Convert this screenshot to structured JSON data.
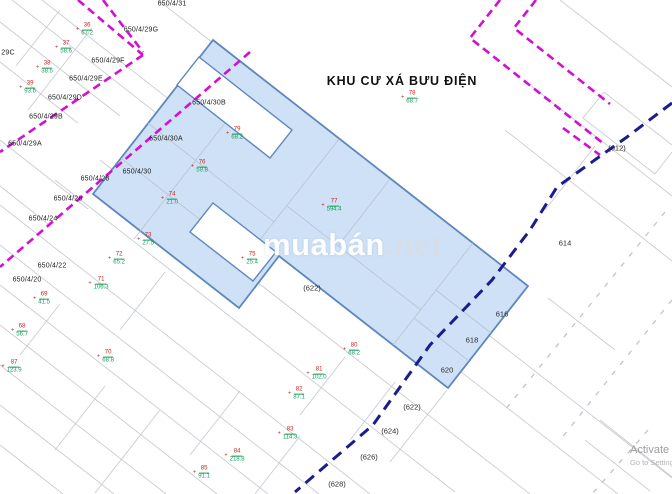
{
  "title": "KHU CƯ XÁ BƯU ĐIỆN",
  "watermark": {
    "brand": "muabán",
    "tld": ".net"
  },
  "activation": {
    "line1": "Activate Windows",
    "line2": "Go to Settings to activate Windows."
  },
  "streets": [
    {
      "label": "650/4/31"
    },
    {
      "label": "650/4/29G"
    },
    {
      "label": "650/4/29F"
    },
    {
      "label": "650/4/29E"
    },
    {
      "label": "650/4/29D"
    },
    {
      "label": "650/4/29B"
    },
    {
      "label": "650/4/29A"
    },
    {
      "label": "29C"
    },
    {
      "label": "650/4/30B"
    },
    {
      "label": "650/4/30A"
    },
    {
      "label": "650/4/30"
    },
    {
      "label": "650/4/28"
    },
    {
      "label": "650/4/26"
    },
    {
      "label": "650/4/24"
    },
    {
      "label": "650/4/22"
    },
    {
      "label": "650/4/20"
    }
  ],
  "flags": [
    {
      "plot": "36",
      "area": "67.2",
      "marker": "+"
    },
    {
      "plot": "37",
      "area": "58.6",
      "marker": "+"
    },
    {
      "plot": "38",
      "area": "38.5",
      "marker": "+"
    },
    {
      "plot": "39",
      "area": "93.6",
      "marker": "+"
    },
    {
      "plot": "78",
      "area": "68.7",
      "marker": "+"
    },
    {
      "plot": "79",
      "area": "68.2",
      "marker": "+"
    },
    {
      "plot": "76",
      "area": "59.8",
      "marker": "+"
    },
    {
      "plot": "74",
      "area": "21.0",
      "marker": "+"
    },
    {
      "plot": "77",
      "area": "594.4",
      "marker": "+"
    },
    {
      "plot": "73",
      "area": "27.5",
      "marker": "+"
    },
    {
      "plot": "75",
      "area": "25.4",
      "marker": "+"
    },
    {
      "plot": "72",
      "area": "65.2",
      "marker": "+"
    },
    {
      "plot": "71",
      "area": "106.3",
      "marker": "+"
    },
    {
      "plot": "69",
      "area": "41.5",
      "marker": "+"
    },
    {
      "plot": "68",
      "area": "56.7",
      "marker": "+"
    },
    {
      "plot": "70",
      "area": "68.8",
      "marker": "+"
    },
    {
      "plot": "87",
      "area": "123.9",
      "marker": "+"
    },
    {
      "plot": "80",
      "area": "68.2",
      "marker": "+"
    },
    {
      "plot": "81",
      "area": "102.0",
      "marker": "+"
    },
    {
      "plot": "82",
      "area": "87.1",
      "marker": "+"
    },
    {
      "plot": "83",
      "area": "114.3",
      "marker": "+"
    },
    {
      "plot": "84",
      "area": "218.8",
      "marker": "+"
    },
    {
      "plot": "85",
      "area": "91.1",
      "marker": "+"
    }
  ],
  "plots": [
    {
      "label": "(612)"
    },
    {
      "label": "614"
    },
    {
      "label": "616"
    },
    {
      "label": "618"
    },
    {
      "label": "620"
    },
    {
      "label": "(622)"
    },
    {
      "label": "(622)"
    },
    {
      "label": "(624)"
    },
    {
      "label": "(626)"
    },
    {
      "label": "(628)"
    }
  ],
  "colors": {
    "magenta": "#d40ed4",
    "navy": "#1c1c8f",
    "parcel-fill": "#cfe1f6",
    "parcel-stroke": "#5d87bd",
    "grid": "#c9cdd3",
    "red": "#cf2020",
    "green": "#18a05a"
  }
}
